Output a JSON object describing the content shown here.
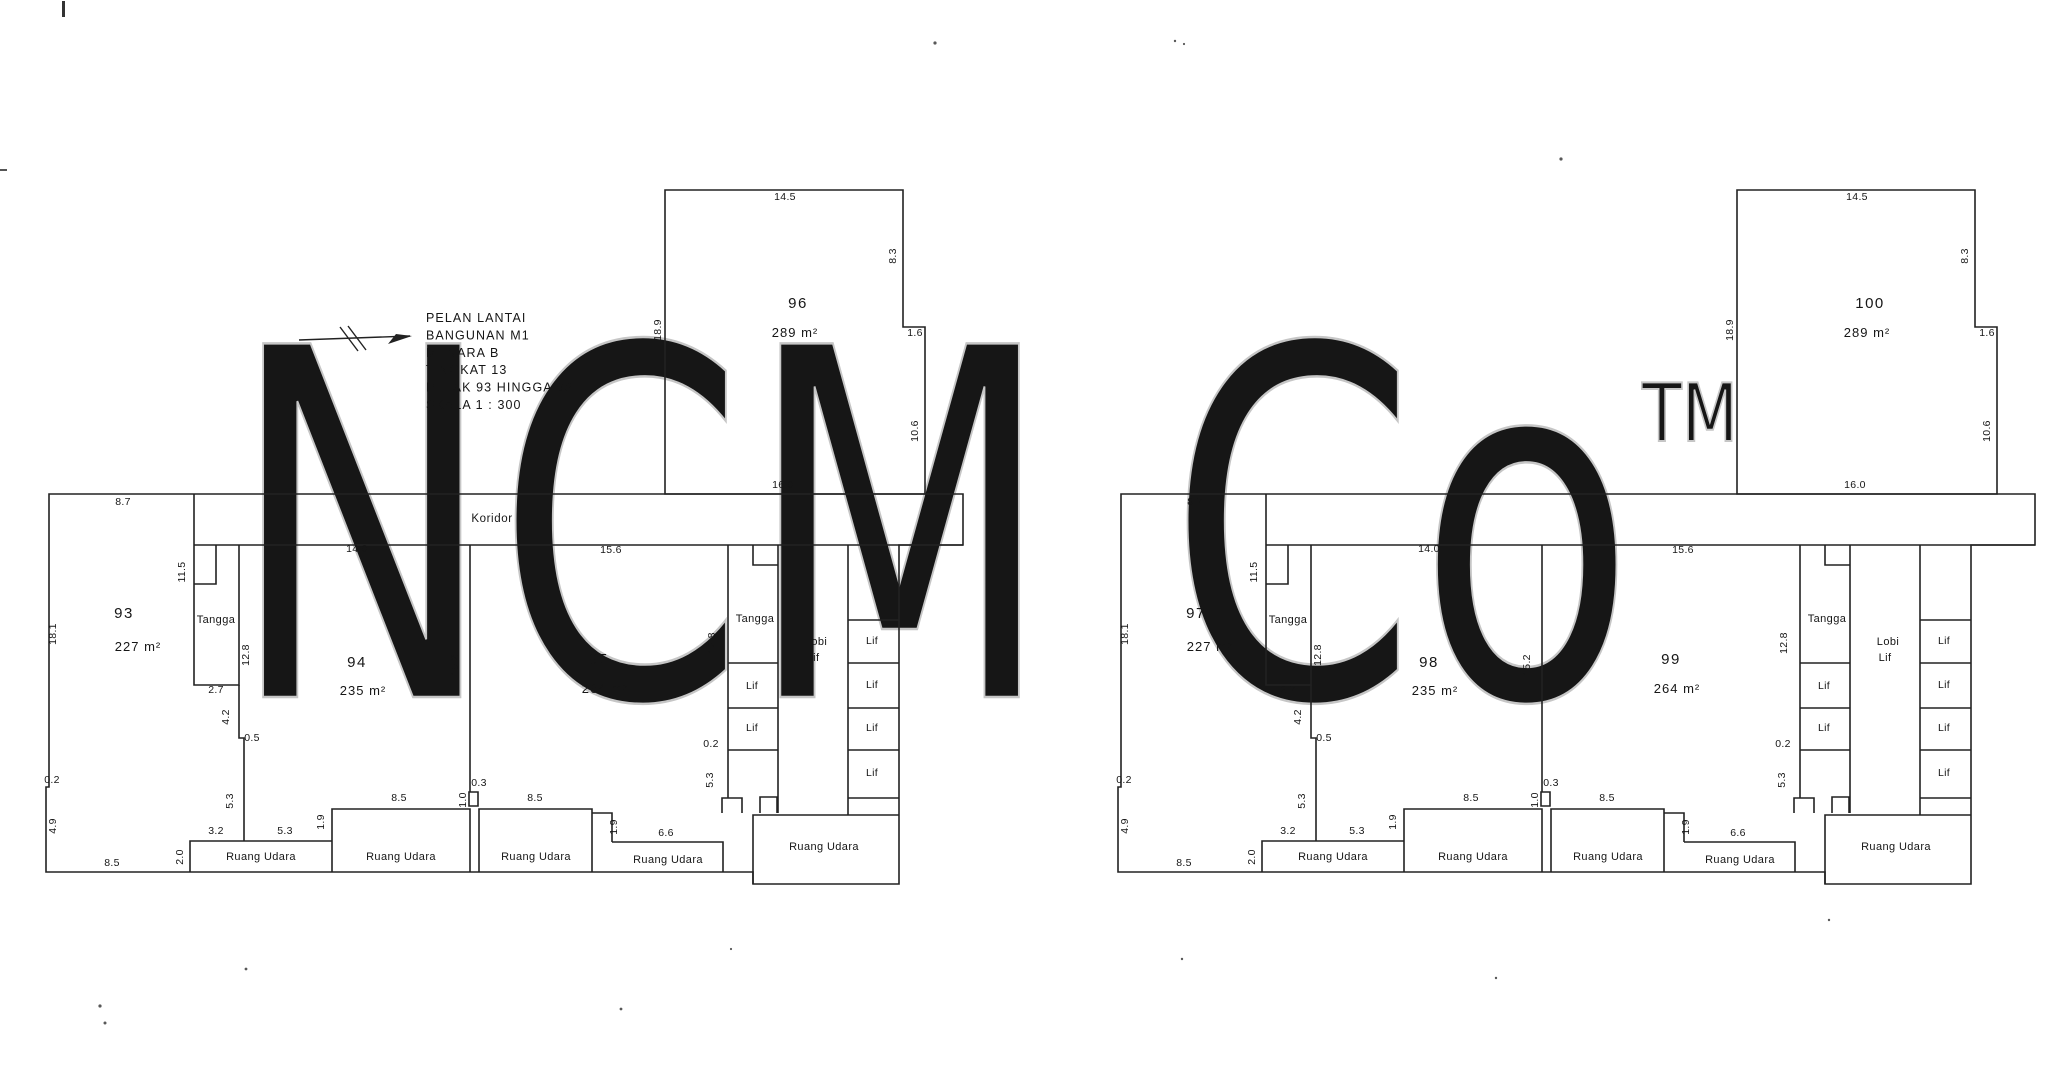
{
  "watermark": {
    "text": "NCM Co",
    "tm_text": "TM",
    "color": "#c6c6c6"
  },
  "common": {
    "tangga_label": "Tangga",
    "lif_label": "Lif",
    "ruang_udara_label": "Ruang Udara",
    "lobi_lif_lines": [
      "Lobi",
      "Lif"
    ]
  },
  "dimensions": {
    "d87": "8.7",
    "d181": "18.1",
    "d02l": "0.2",
    "d49": "4.9",
    "d85b": "8.5",
    "d115": "11.5",
    "d128a": "12.8",
    "d27": "2.7",
    "d42": "4.2",
    "d05": "0.5",
    "d53a": "5.3",
    "d32": "3.2",
    "d53b": "5.3",
    "d20": "2.0",
    "d19a": "1.9",
    "d85c": "8.5",
    "d03": "0.3",
    "d10": "1.0",
    "d85d": "8.5",
    "d19c": "1.9",
    "d66": "6.6",
    "d140": "14.0",
    "d156": "15.6",
    "d152": "15.2",
    "d128b": "12.8",
    "d02r": "0.2",
    "d53c": "5.3",
    "d145": "14.5",
    "d83": "8.3",
    "d16": "1.6",
    "d106": "10.6",
    "d160": "16.0",
    "d189": "18.9"
  },
  "plans": [
    {
      "title_lines": [
        "PELAN LANTAI",
        "BANGUNAN M1",
        "MENARA B",
        "TINGKAT 13",
        "PETAK 93 HINGGA 96",
        "SKALA 1 : 300"
      ],
      "koridor_label": "Koridor",
      "rooms": [
        {
          "number": "93",
          "area": "227 m²"
        },
        {
          "number": "94",
          "area": "235 m²"
        },
        {
          "number": "95",
          "area": "264 m²"
        },
        {
          "number": "96",
          "area": "289 m²"
        }
      ]
    },
    {
      "title_lines": [
        "PELAN LANTAI",
        "BANGUNAN M1",
        "MENARA B",
        "TINGKAT 14",
        "PETAK 97 HINGGA 100",
        "SKALA 1 : 300"
      ],
      "koridor_label": "",
      "rooms": [
        {
          "number": "97",
          "area": "227 m²"
        },
        {
          "number": "98",
          "area": "235 m²"
        },
        {
          "number": "99",
          "area": "264 m²"
        },
        {
          "number": "100",
          "area": "289 m²"
        }
      ]
    }
  ]
}
